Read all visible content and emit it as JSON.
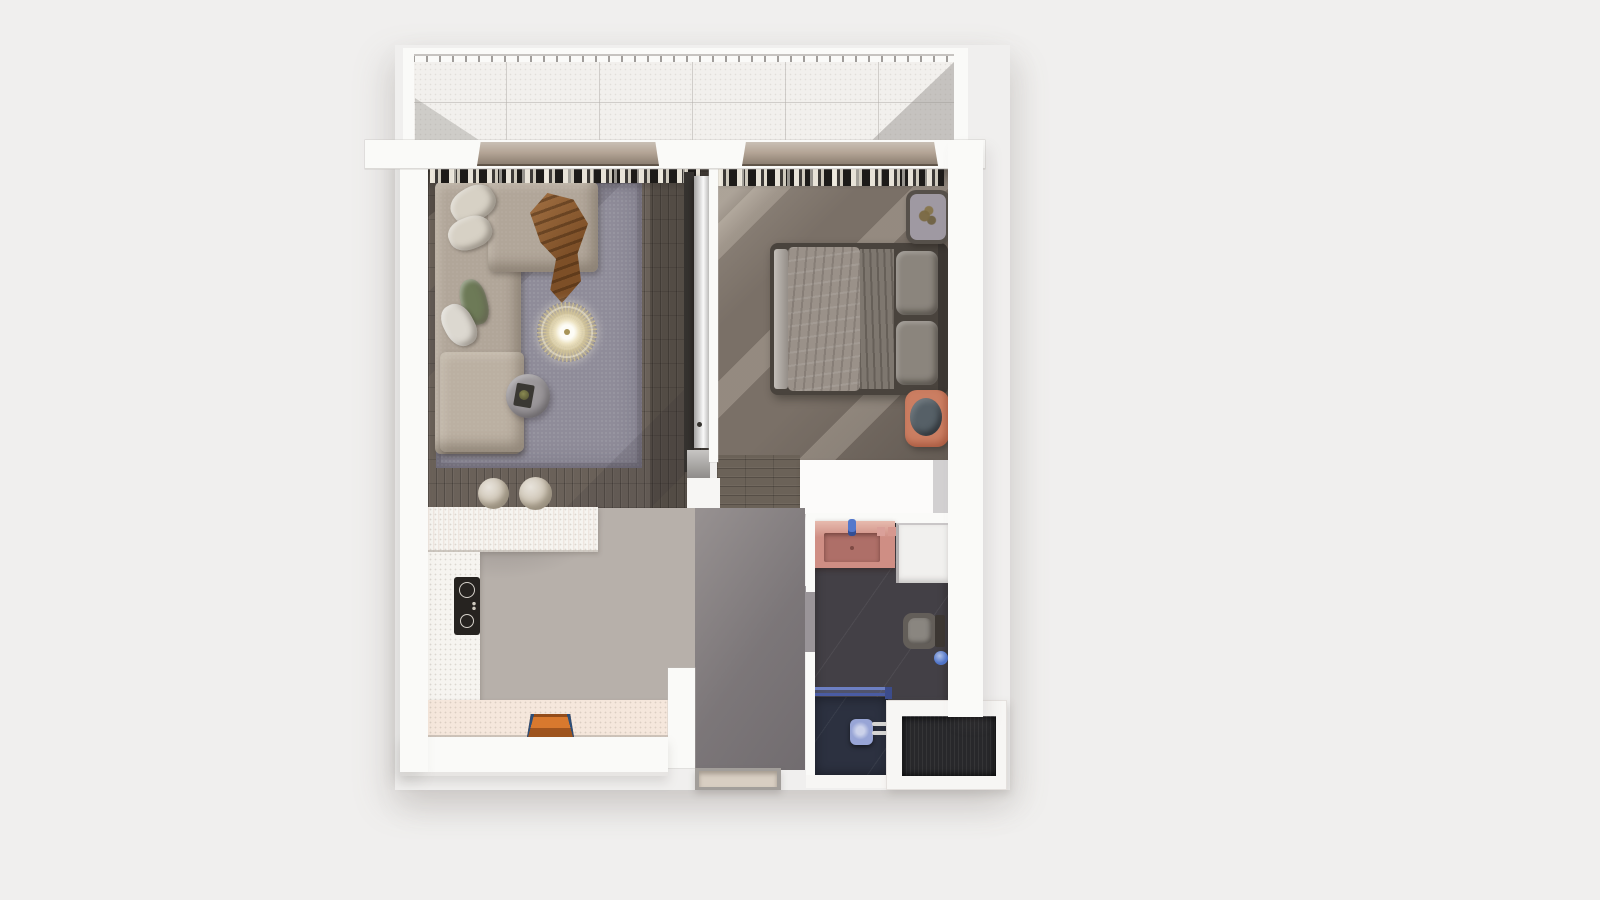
{
  "scene": {
    "description": "3D top-down architectural render of a one-bedroom apartment floor plan with balcony, no visible text labels",
    "rooms": [
      {
        "name": "balcony"
      },
      {
        "name": "living-room"
      },
      {
        "name": "kitchen"
      },
      {
        "name": "hallway"
      },
      {
        "name": "bedroom"
      },
      {
        "name": "bathroom"
      },
      {
        "name": "entry"
      }
    ],
    "furniture": [
      "sectional-sofa",
      "throw-blanket",
      "decor-pillows",
      "pendant-chandelier",
      "coffee-table",
      "area-rug",
      "bar-stools",
      "kitchen-island",
      "cooktop",
      "serving-tray",
      "double-bed",
      "nightstand",
      "plant",
      "ottoman-pouf",
      "wardrobe",
      "vanity-sink",
      "washing-machine",
      "toilet",
      "shower",
      "entrance-doormat",
      "curtains",
      "sliding-door-lintels"
    ]
  },
  "palette": {
    "page_bg": "#f0efee",
    "wall_white": "#fafaf8",
    "slab_white": "#f7f6f4",
    "wall_shade": "#e3e1df",
    "balcony_tile": "#f2f0ed",
    "railing": "#b7b4b1",
    "lintel": "#b3a495",
    "curtain_dark": "#1d1b19",
    "living_floor": "#6a6159",
    "rug": "#8f8c99",
    "sofa": "#b1a699",
    "sofa_light": "#bbb0a2",
    "pillow_cream": "#d7d1c5",
    "pillow_white": "#dcd8d0",
    "pillow_green": "#6d7a57",
    "throw_brown": "#7d4f27",
    "chandelier_gold": "#d3c59a",
    "table_gray": "#9c989b",
    "tray_dark": "#3a3833",
    "stool_beige": "#cbc1b0",
    "bedroom_floor": "#7a7067",
    "corridor_floor": "#6b6258",
    "bed_frame": "#49433d",
    "duvet": "#9a9189",
    "sheet": "#7e776f",
    "bed_pillow": "#8b857d",
    "bench": "#a9a29b",
    "headboard": "#3c3733",
    "nightstand": "#56504a",
    "nightstand_top": "#9f99a2",
    "plant": "#7b6a44",
    "pouf_orange": "#cb7e62",
    "pouf_cushion": "#566067",
    "marble": "#b7b0aa",
    "marble_hall": "#a29c9b",
    "marble_patch": "#9a9599",
    "counter_white": "#f6f4f0",
    "counter_warm": "#f5e7dc",
    "cooktop_black": "#262320",
    "tray_orange": "#d8792e",
    "tray_blue": "#2d4e78",
    "bath_floor": "#434046",
    "shower_floor": "#2c3140",
    "vanity_pink": "#cf8e84",
    "sink_inner": "#ae6f68",
    "faucet_blue": "#5478cc",
    "soap_pink": "#daa099",
    "washer_white": "#f1f0ee",
    "toilet_body": "#635e59",
    "toilet_lid": "#8a8680",
    "flush_blue": "#4f74c9",
    "glass_blue": "#5a6fb8",
    "shower_head": "#98a5d6",
    "chrome": "#d6d5d3",
    "mat_dark": "#28282b",
    "threshold": "#d8cec2",
    "threshold_frame": "#a29e9a",
    "door_panel": "#d9d8d7",
    "recess_dark": "#35322f",
    "pier_gray": "#9d9a97",
    "cabinet_gray": "#a9a6a3",
    "wardrobe_white": "#fcfbfa",
    "wardrobe_side": "#d2d0d1"
  }
}
